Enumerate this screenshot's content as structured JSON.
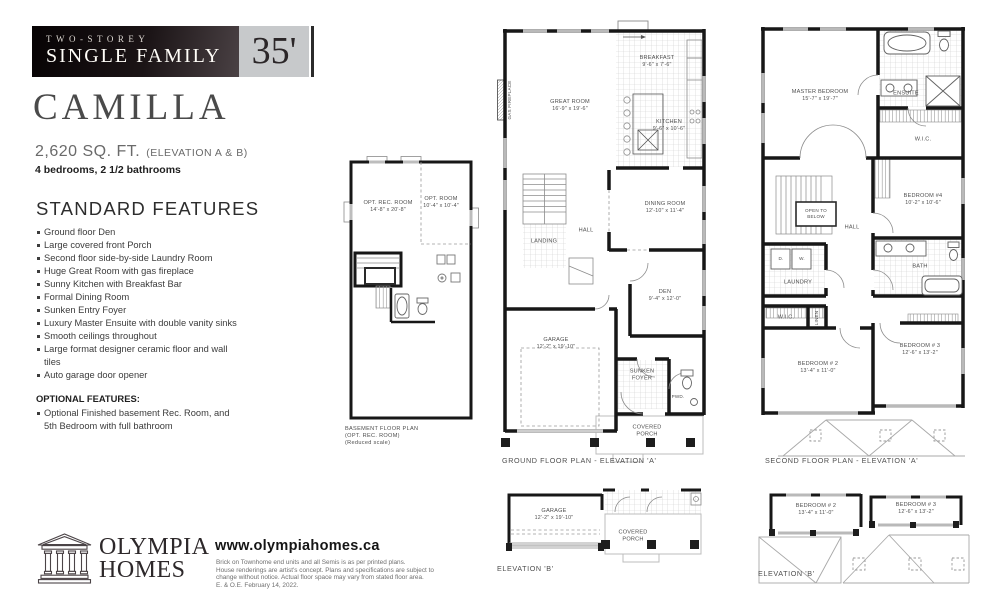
{
  "banner": {
    "line1": "TWO-STOREY",
    "line2": "SINGLE FAMILY",
    "lot_width": "35'"
  },
  "model": {
    "name": "CAMILLA",
    "sqft": "2,620 SQ. FT.",
    "elevation_note": "(ELEVATION A & B)",
    "config": "4 bedrooms, 2 1/2 bathrooms"
  },
  "standard_features": {
    "heading": "STANDARD FEATURES",
    "items": [
      "Ground floor Den",
      "Large covered front Porch",
      "Second floor side-by-side Laundry Room",
      "Huge Great Room with gas fireplace",
      "Sunny Kitchen with Breakfast Bar",
      "Formal Dining Room",
      "Sunken Entry Foyer",
      "Luxury Master Ensuite with double vanity sinks",
      "Smooth ceilings throughout",
      "Large format designer ceramic floor and wall tiles",
      "Auto garage door opener"
    ]
  },
  "optional_features": {
    "heading": "OPTIONAL FEATURES:",
    "items": [
      "Optional Finished basement Rec. Room, and 5th Bedroom with full bathroom"
    ]
  },
  "footer": {
    "brand_line1": "OLYMPIA",
    "brand_line2": "HOMES",
    "website": "www.olympiahomes.ca",
    "disclaimer_lines": [
      "Brick on Townhome end units and all Semis is as per printed plans.",
      "House renderings are artist's concept. Plans and specifications are subject to",
      "change without notice. Actual floor space may vary from stated floor area.",
      "E. & O.E.    February 14, 2022."
    ]
  },
  "plans": {
    "basement": {
      "caption_lines": [
        "BASEMENT FLOOR PLAN",
        "(OPT. REC. ROOM)",
        "(Reduced scale)"
      ],
      "rooms": {
        "rec": {
          "name": "OPT. REC. ROOM",
          "dims": "14'-8\" x 20'-8\""
        },
        "opt": {
          "name": "OPT. ROOM",
          "dims": "10'-4\" x 10'-4\""
        }
      }
    },
    "ground_a": {
      "caption": "GROUND FLOOR PLAN - ELEVATION 'A'",
      "rooms": {
        "great": {
          "name": "GREAT ROOM",
          "dims": "16'-9\" x 19'-6\""
        },
        "breakfast": {
          "name": "BREAKFAST",
          "dims": "9'-6\" x 7'-6\""
        },
        "kitchen": {
          "name": "KITCHEN",
          "dims": "9'-6\" x 10'-6\""
        },
        "dining": {
          "name": "DINING ROOM",
          "dims": "12'-10\" x 11'-4\""
        },
        "den": {
          "name": "DEN",
          "dims": "9'-4\" x 12'-0\""
        },
        "garage": {
          "name": "GARAGE",
          "dims": "12'-2\" x 19'-10\""
        },
        "hall": {
          "name": "HALL"
        },
        "landing": {
          "name": "LANDING"
        },
        "foyer": {
          "name": "SUNKEN FOYER"
        },
        "pwd": {
          "name": "PWD."
        },
        "porch": {
          "name": "COVERED PORCH"
        },
        "fireplace": {
          "name": "GAS FIREPLACE"
        }
      }
    },
    "second_a": {
      "caption": "SECOND FLOOR PLAN - ELEVATION 'A'",
      "rooms": {
        "master": {
          "name": "MASTER BEDROOM",
          "dims": "15'-7\" x 19'-7\""
        },
        "ensuite": {
          "name": "ENSUITE"
        },
        "wic_master": {
          "name": "W.I.C."
        },
        "bedroom4": {
          "name": "BEDROOM #4",
          "dims": "10'-2\" x 10'-6\""
        },
        "hall": {
          "name": "HALL"
        },
        "open_below": {
          "name": "OPEN TO BELOW"
        },
        "laundry": {
          "name": "LAUNDRY"
        },
        "dryer": {
          "name": "D."
        },
        "washer": {
          "name": "W."
        },
        "bath": {
          "name": "BATH"
        },
        "wic2": {
          "name": "W.I.C."
        },
        "linen": {
          "name": "LINEN"
        },
        "bedroom2": {
          "name": "BEDROOM # 2",
          "dims": "13'-4\" x 11'-0\""
        },
        "bedroom3": {
          "name": "BEDROOM # 3",
          "dims": "12'-6\" x 13'-2\""
        }
      }
    },
    "ground_b": {
      "caption": "ELEVATION 'B'",
      "rooms": {
        "garage": {
          "name": "GARAGE",
          "dims": "12'-2\" x 19'-10\""
        },
        "porch": {
          "name": "COVERED PORCH"
        }
      }
    },
    "second_b": {
      "caption": "ELEVATION 'B'",
      "rooms": {
        "bedroom2": {
          "name": "BEDROOM # 2",
          "dims": "13'-4\" x 11'-0\""
        },
        "bedroom3": {
          "name": "BEDROOM # 3",
          "dims": "12'-6\" x 13'-2\""
        }
      }
    }
  }
}
